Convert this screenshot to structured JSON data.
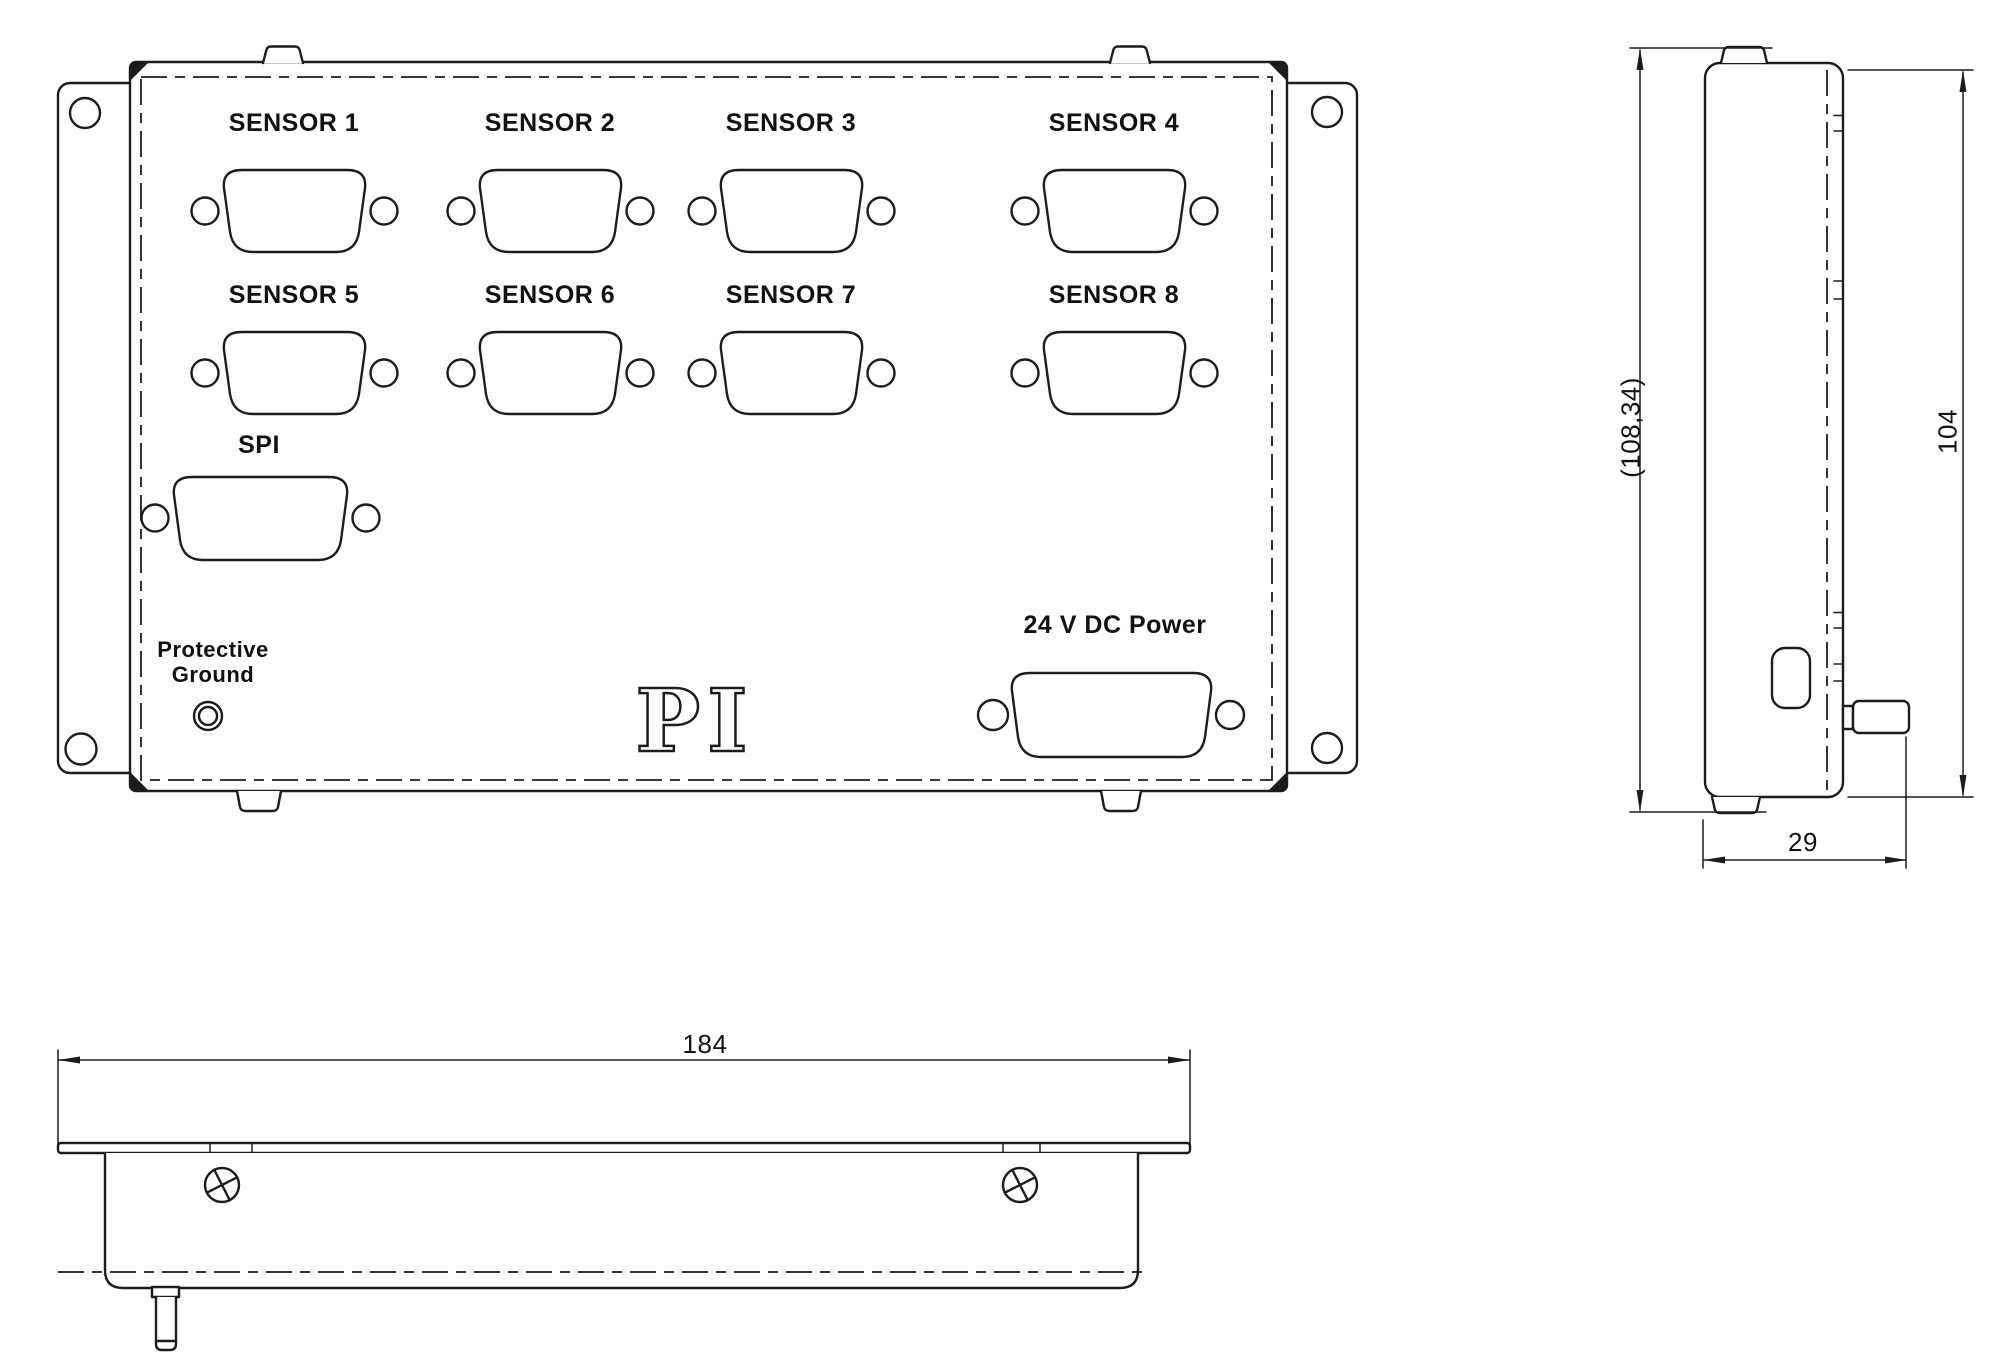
{
  "front_view": {
    "sensors": [
      "SENSOR 1",
      "SENSOR 2",
      "SENSOR 3",
      "SENSOR 4",
      "SENSOR 5",
      "SENSOR 6",
      "SENSOR 7",
      "SENSOR 8"
    ],
    "spi_label": "SPI",
    "ground_label": {
      "line1": "Protective",
      "line2": "Ground"
    },
    "power_label": "24 V DC Power",
    "logo_text": "PI"
  },
  "side_view": {
    "overall_height_dim": "(108,34)",
    "body_height_dim": "104",
    "depth_dim": "29"
  },
  "bottom_view": {
    "width_dim": "184"
  },
  "colors": {
    "line": "#1c1c1c",
    "background": "#ffffff"
  }
}
